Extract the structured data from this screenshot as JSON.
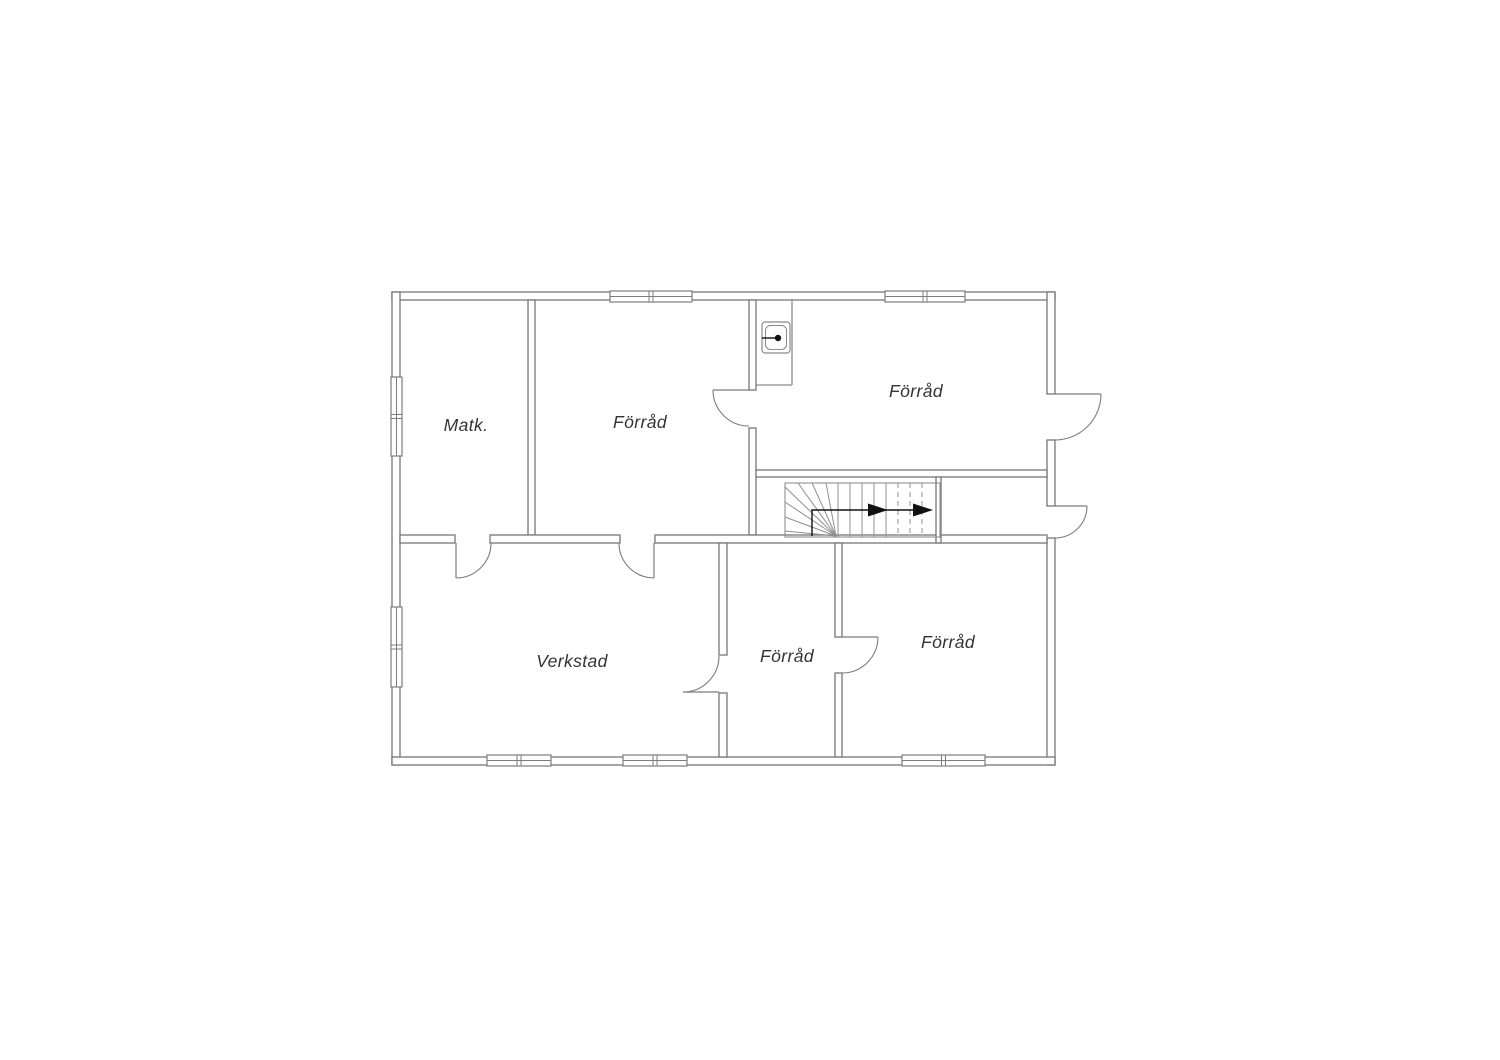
{
  "page": {
    "background": "#ffffff",
    "width": 1500,
    "height": 1060
  },
  "floorplan": {
    "style": {
      "wall_stroke": "#767676",
      "wall_fill": "#ffffff",
      "thin_stroke": "#8a8a8a",
      "stair_stroke": "#8f8f8f",
      "door_stroke": "#7d7d7d",
      "window_stroke": "#7d7d7d",
      "text_color": "#333333",
      "arrow_color": "#111111",
      "label_font_size": 17.5
    },
    "rooms": [
      {
        "name": "matk",
        "label": "Matk.",
        "label_x": 466,
        "label_y": 425
      },
      {
        "name": "forrad-top",
        "label": "Förråd",
        "label_x": 640,
        "label_y": 422
      },
      {
        "name": "forrad-right",
        "label": "Förråd",
        "label_x": 916,
        "label_y": 391
      },
      {
        "name": "verkstad",
        "label": "Verkstad",
        "label_x": 572,
        "label_y": 661
      },
      {
        "name": "forrad-mid",
        "label": "Förråd",
        "label_x": 787,
        "label_y": 656
      },
      {
        "name": "forrad-bottom",
        "label": "Förråd",
        "label_x": 948,
        "label_y": 642
      }
    ],
    "walls": [
      {
        "name": "exterior-wall-top",
        "x": 392,
        "y": 292,
        "w": 663,
        "h": 8
      },
      {
        "name": "exterior-wall-left",
        "x": 392,
        "y": 292,
        "w": 8,
        "h": 473
      },
      {
        "name": "exterior-wall-right-upper",
        "x": 1047,
        "y": 292,
        "w": 8,
        "h": 102
      },
      {
        "name": "exterior-wall-right-middle",
        "x": 1047,
        "y": 440,
        "w": 8,
        "h": 66
      },
      {
        "name": "exterior-wall-right-lower",
        "x": 1047,
        "y": 538,
        "w": 8,
        "h": 227
      },
      {
        "name": "exterior-wall-bottom",
        "x": 392,
        "y": 757,
        "w": 663,
        "h": 8
      },
      {
        "name": "wall-matk-forrad",
        "x": 528,
        "y": 300,
        "w": 7,
        "h": 235
      },
      {
        "name": "wall-forrad-hall-upper",
        "x": 749,
        "y": 300,
        "w": 7,
        "h": 90
      },
      {
        "name": "wall-forrad-hall-lower",
        "x": 749,
        "y": 428,
        "w": 7,
        "h": 107
      },
      {
        "name": "wall-mid-band-left",
        "x": 400,
        "y": 535,
        "w": 55,
        "h": 8
      },
      {
        "name": "wall-mid-band-center",
        "x": 490,
        "y": 535,
        "w": 130,
        "h": 8
      },
      {
        "name": "wall-mid-band-right",
        "x": 655,
        "y": 535,
        "w": 392,
        "h": 8
      },
      {
        "name": "wall-verkstad-forrad-upper",
        "x": 719,
        "y": 543,
        "w": 8,
        "h": 112
      },
      {
        "name": "wall-verkstad-forrad-lower",
        "x": 719,
        "y": 693,
        "w": 8,
        "h": 64
      },
      {
        "name": "wall-forrad-forrad-upper",
        "x": 835,
        "y": 543,
        "w": 7,
        "h": 94
      },
      {
        "name": "wall-forrad-forrad-lower",
        "x": 835,
        "y": 673,
        "w": 7,
        "h": 84
      },
      {
        "name": "wall-forrad-right-bottom",
        "x": 756,
        "y": 470,
        "w": 291,
        "h": 7
      },
      {
        "name": "wall-stair-right",
        "x": 936,
        "y": 477,
        "w": 5,
        "h": 66
      }
    ],
    "windows": [
      {
        "name": "window-top-forrad",
        "x": 610,
        "y": 291,
        "w": 82,
        "h": 11,
        "dir": "h"
      },
      {
        "name": "window-top-forrad-right",
        "x": 885,
        "y": 291,
        "w": 80,
        "h": 11,
        "dir": "h"
      },
      {
        "name": "window-left-matk",
        "x": 391,
        "y": 377,
        "w": 11,
        "h": 79,
        "dir": "v"
      },
      {
        "name": "window-left-verkstad",
        "x": 391,
        "y": 607,
        "w": 11,
        "h": 80,
        "dir": "v"
      },
      {
        "name": "window-bottom-verkstad-1",
        "x": 487,
        "y": 755,
        "w": 64,
        "h": 11,
        "dir": "h"
      },
      {
        "name": "window-bottom-verkstad-2",
        "x": 623,
        "y": 755,
        "w": 64,
        "h": 11,
        "dir": "h"
      },
      {
        "name": "window-bottom-forrad",
        "x": 902,
        "y": 755,
        "w": 83,
        "h": 11,
        "dir": "h"
      }
    ],
    "doors": [
      {
        "name": "door-matk-verkstad",
        "leaf": [
          456,
          543,
          456,
          578
        ],
        "arc_from": [
          456,
          578
        ],
        "arc_to": [
          491,
          543
        ],
        "r": 35,
        "sweep": 0
      },
      {
        "name": "door-forrad-verkstad",
        "leaf": [
          654,
          543,
          654,
          578
        ],
        "arc_from": [
          654,
          578
        ],
        "arc_to": [
          619,
          543
        ],
        "r": 35,
        "sweep": 1
      },
      {
        "name": "door-verkstad-forrad",
        "leaf": [
          719,
          692,
          683,
          692
        ],
        "arc_from": [
          683,
          692
        ],
        "arc_to": [
          719,
          656
        ],
        "r": 36,
        "sweep": 0
      },
      {
        "name": "door-forrad-forrad",
        "leaf": [
          842,
          637,
          878,
          637
        ],
        "arc_from": [
          878,
          637
        ],
        "arc_to": [
          842,
          673
        ],
        "r": 36,
        "sweep": 1
      },
      {
        "name": "door-forrad-hall",
        "leaf": [
          749,
          390,
          713,
          390
        ],
        "arc_from": [
          713,
          390
        ],
        "arc_to": [
          749,
          426
        ],
        "r": 36,
        "sweep": 0
      },
      {
        "name": "door-exterior-upper",
        "leaf": [
          1055,
          394,
          1101,
          394
        ],
        "arc_from": [
          1101,
          394
        ],
        "arc_to": [
          1055,
          440
        ],
        "r": 46,
        "sweep": 1
      },
      {
        "name": "door-exterior-lower",
        "leaf": [
          1055,
          506,
          1087,
          506
        ],
        "arc_from": [
          1087,
          506
        ],
        "arc_to": [
          1055,
          538
        ],
        "r": 32,
        "sweep": 1
      }
    ],
    "thin_lines": [
      {
        "name": "sink-alcove-side",
        "x1": 792,
        "y1": 300,
        "x2": 792,
        "y2": 385
      },
      {
        "name": "sink-alcove-front",
        "x1": 756,
        "y1": 385,
        "x2": 792,
        "y2": 385
      }
    ],
    "stairs": {
      "name": "staircase",
      "box": {
        "x": 785,
        "y": 483,
        "w": 155,
        "h": 54
      },
      "fan_center": [
        836,
        536
      ],
      "fan_points": [
        [
          785,
          531
        ],
        [
          785,
          517
        ],
        [
          785,
          502
        ],
        [
          785,
          487
        ],
        [
          798,
          483
        ],
        [
          812,
          483
        ],
        [
          826,
          483
        ]
      ],
      "risers_solid": [
        838,
        850,
        862,
        874,
        886
      ],
      "risers_dashed": [
        898,
        910,
        922
      ],
      "riser_top": 483,
      "riser_bottom": 537,
      "arrow": {
        "name": "stairs-direction-arrow",
        "path": [
          [
            812,
            536
          ],
          [
            812,
            510
          ],
          [
            929,
            510
          ]
        ],
        "heads": [
          [
            888,
            510
          ],
          [
            933,
            510
          ]
        ],
        "head_w": 20,
        "head_h": 13
      }
    },
    "sink": {
      "name": "sink",
      "outer": {
        "x": 762,
        "y": 322,
        "w": 28,
        "h": 31,
        "r": 3
      },
      "inner": {
        "x": 765.5,
        "y": 325.5,
        "w": 21,
        "h": 24,
        "r": 5
      },
      "faucet_line": [
        762,
        338,
        777,
        338
      ],
      "faucet_dot": [
        778,
        338,
        3.2
      ]
    }
  }
}
